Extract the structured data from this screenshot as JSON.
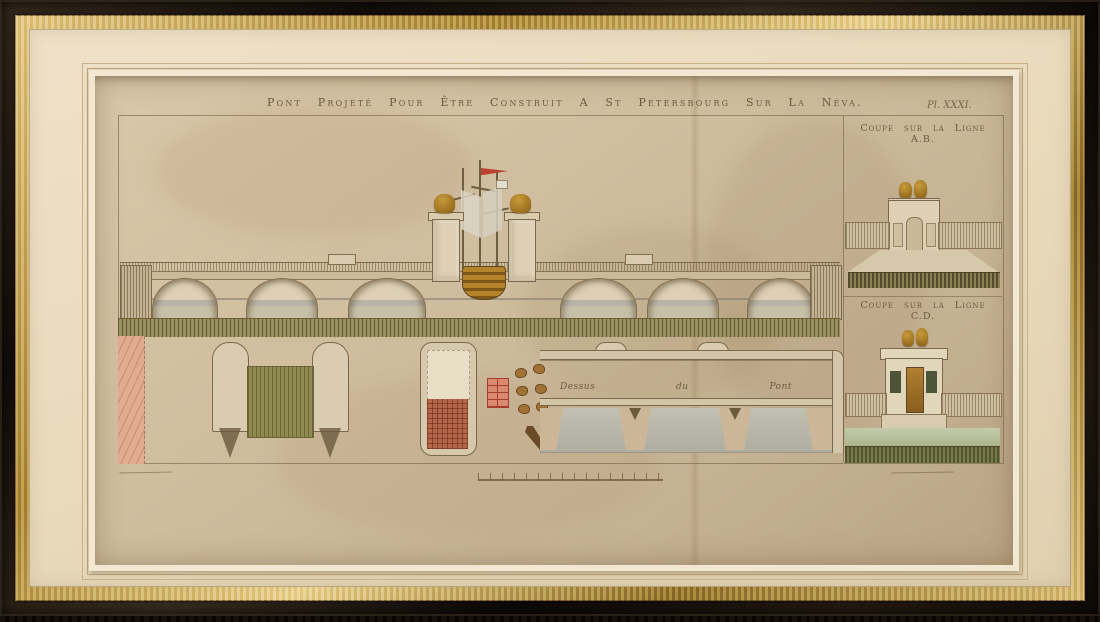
{
  "artwork": {
    "title": "Pont Projeté Pour Être Construit A St Petersbourg Sur La Néva.",
    "plate_label": "Pl. XXXI.",
    "section_ab_label": "Coupe sur la Ligne A.B.",
    "section_cd_label": "Coupe sur la Ligne C.D.",
    "plan_label": {
      "word1": "Dessus",
      "word2": "du",
      "word3": "Pont"
    }
  },
  "palette": {
    "frame_wood": "#17110b",
    "frame_gold": "#c2a35f",
    "mat_cream": "#e9dabc",
    "paper_tan": "#cdbb9c",
    "ink_sepia": "#6d5a40",
    "wash_olive": "#8f8a4f",
    "wash_pink": "#e0ab90",
    "wash_water_gray": "#b7b6a8",
    "wash_water_green": "#b9c4a4",
    "ornament_gold": "#a8791f",
    "flag_red": "#b9412e"
  }
}
